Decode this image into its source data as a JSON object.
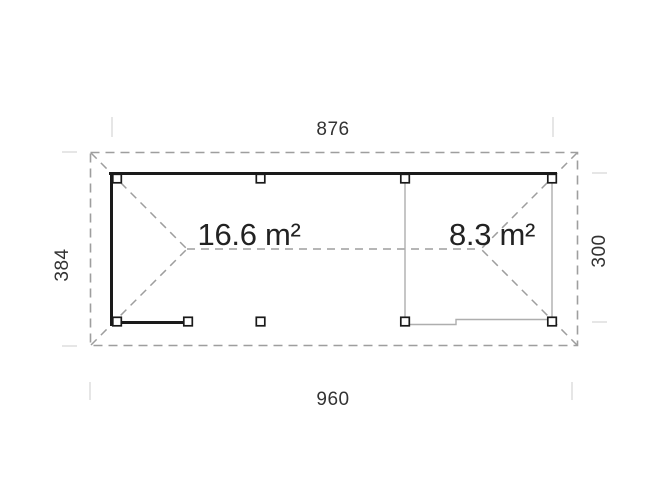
{
  "diagram": {
    "areas": {
      "carport_label": "16.6 m²",
      "glass_room_label": "8.3 m²"
    },
    "dimensions": {
      "top": "876",
      "bottom": "960",
      "left": "384",
      "right": "300"
    },
    "colors": {
      "background": "#ffffff",
      "solid_wall": "#1a1a1a",
      "roof_dashed": "#9e9e9e",
      "thin_glass_wall": "#aeaeae",
      "extension_tick": "#d8d8d8",
      "post_fill": "#ffffff",
      "text": "#2f2f2f"
    }
  }
}
